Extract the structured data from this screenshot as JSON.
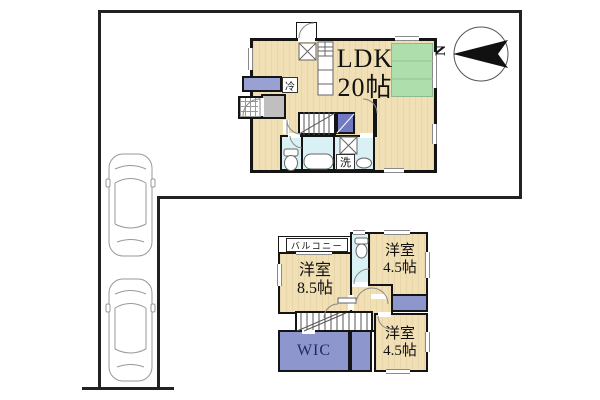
{
  "compass": {
    "north_label": "N"
  },
  "floor1": {
    "ldk": {
      "name": "LDK",
      "size": "20帖"
    },
    "fridge_label": "冷",
    "laundry_label": "洗"
  },
  "floor2": {
    "balcony_label": "バルコニー",
    "rooms": [
      {
        "name": "洋室",
        "size": "8.5帖"
      },
      {
        "name": "洋室",
        "size": "4.5帖"
      },
      {
        "name": "洋室",
        "size": "4.5帖"
      }
    ],
    "wic_label": "WIC"
  },
  "colors": {
    "floor_wood": "#F1DFB5",
    "tatami_green": "#AEDEAB",
    "closet_purple": "#8E96CE",
    "stair_storage_purple": "#7079C1",
    "wet_area_blue": "#D9F1F4",
    "hall_gray": "#BFBFBF",
    "shoe_cabinet_blue": "#99A0D4",
    "wall_black": "#141414"
  }
}
